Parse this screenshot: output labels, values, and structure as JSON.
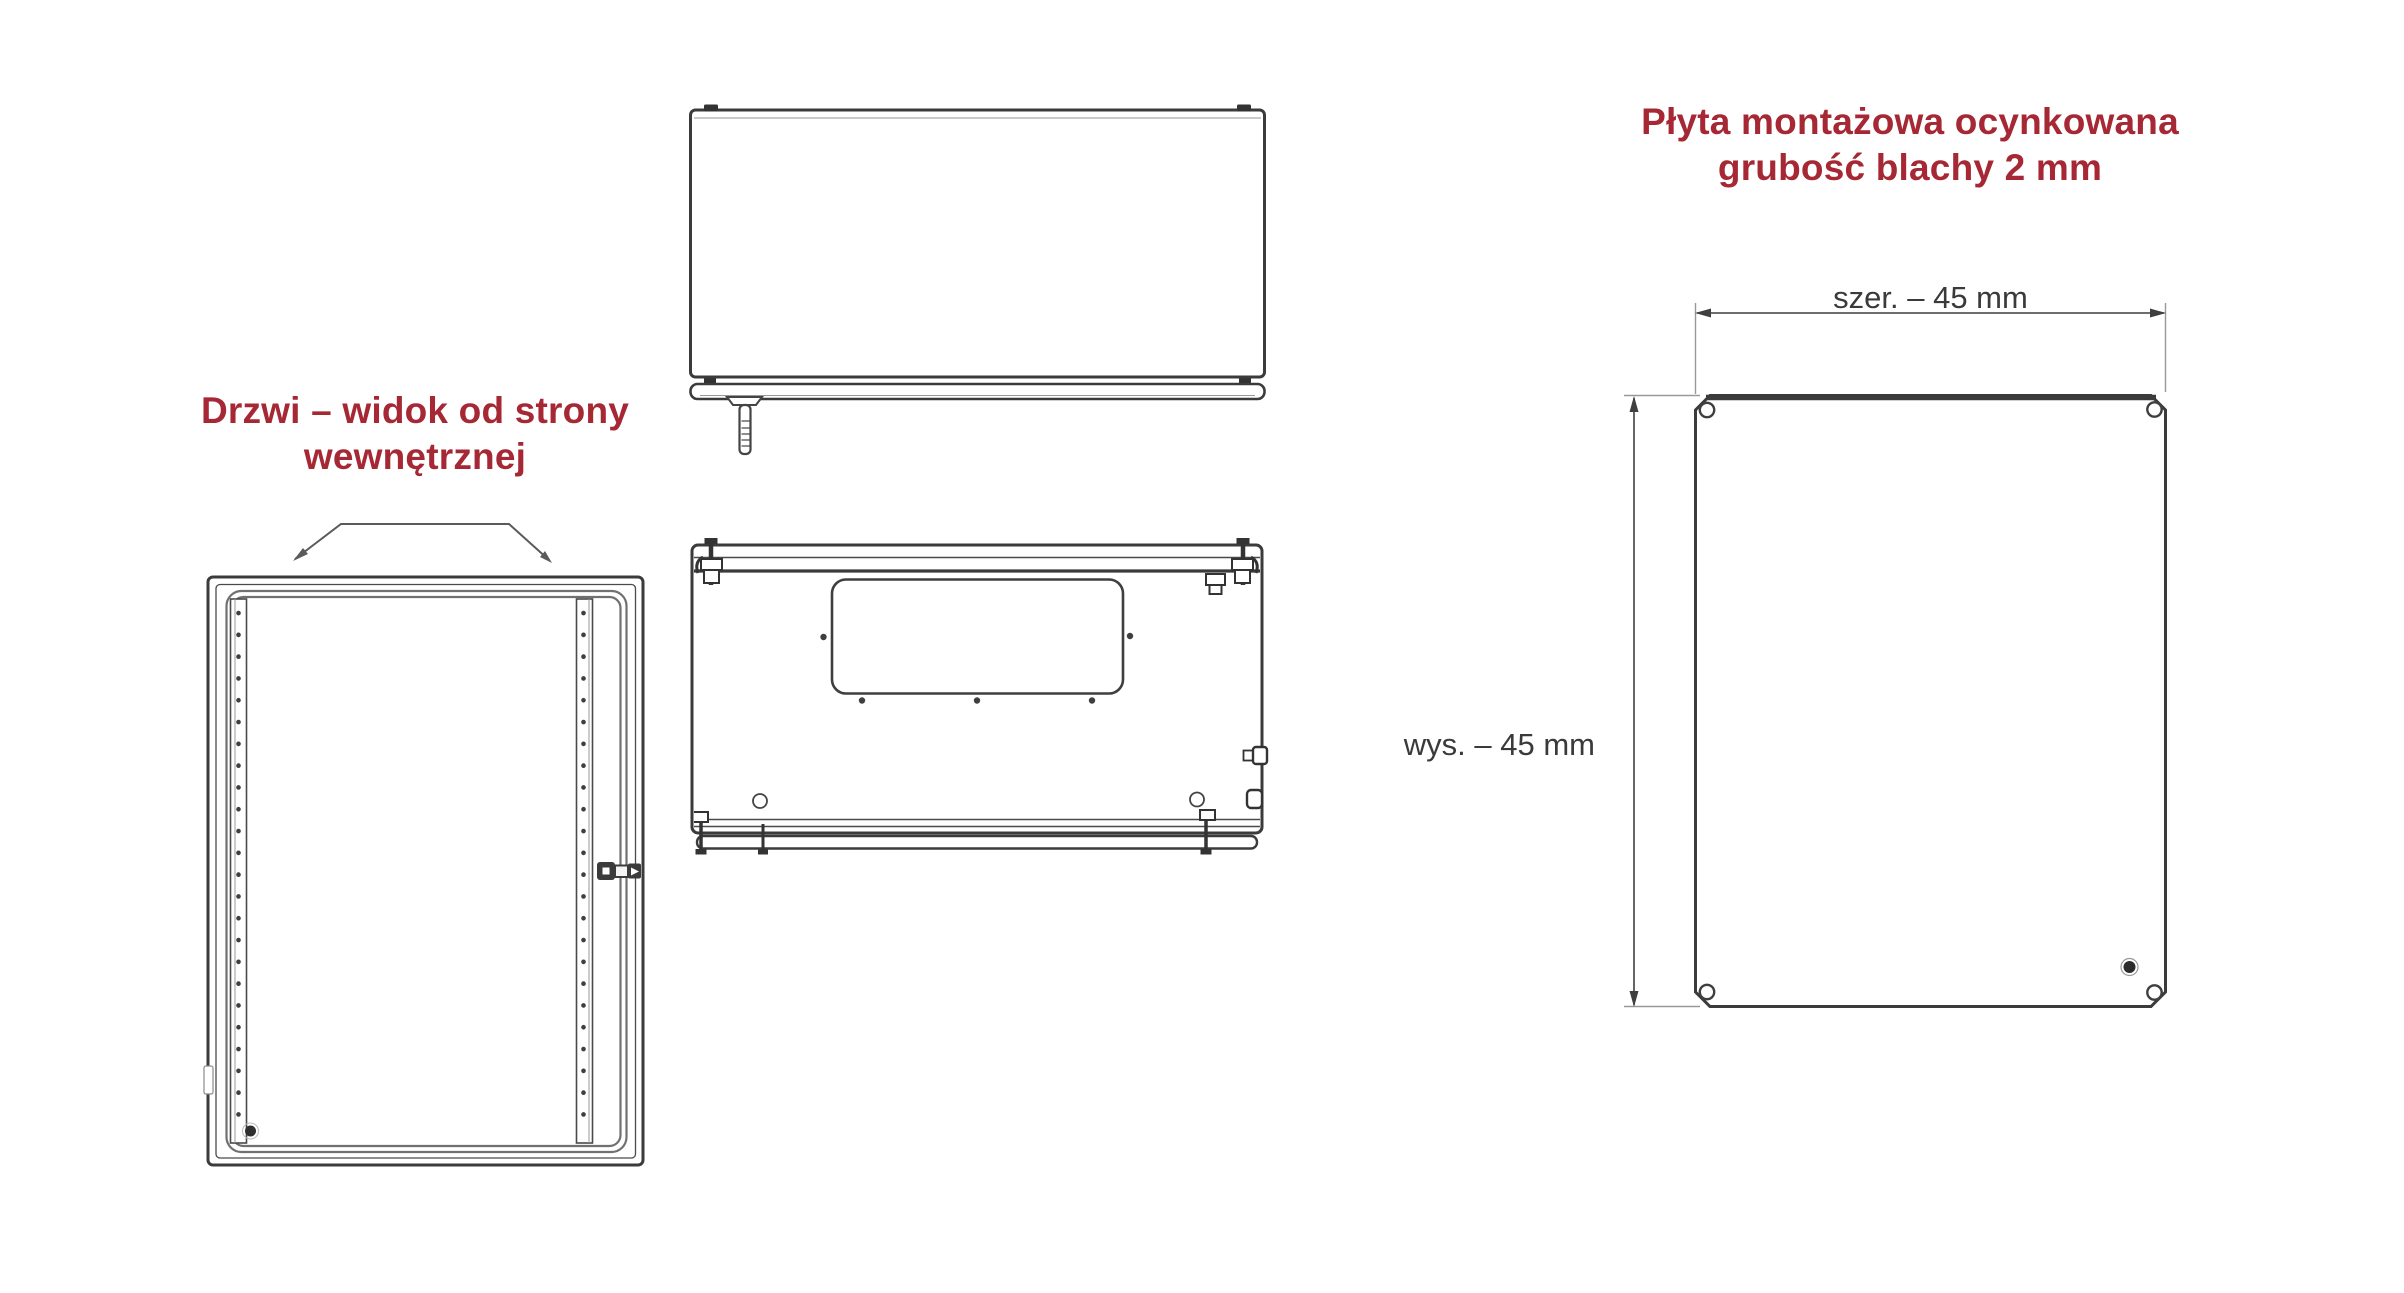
{
  "colors": {
    "accent_red": "#a52834",
    "line_dark": "#3b3b3b",
    "line_mid": "#555555",
    "line_light": "#999999",
    "dim_text": "#3a3a3a",
    "background": "#ffffff"
  },
  "door_view": {
    "title": {
      "line1": "Drzwi – widok od strony",
      "line2": "wewnętrznej"
    }
  },
  "plate_view": {
    "title": {
      "line1": "Płyta montażowa ocynkowana",
      "line2": "grubość blachy 2 mm"
    },
    "dim_width": "szer. – 45 mm",
    "dim_height": "wys. – 45 mm"
  }
}
